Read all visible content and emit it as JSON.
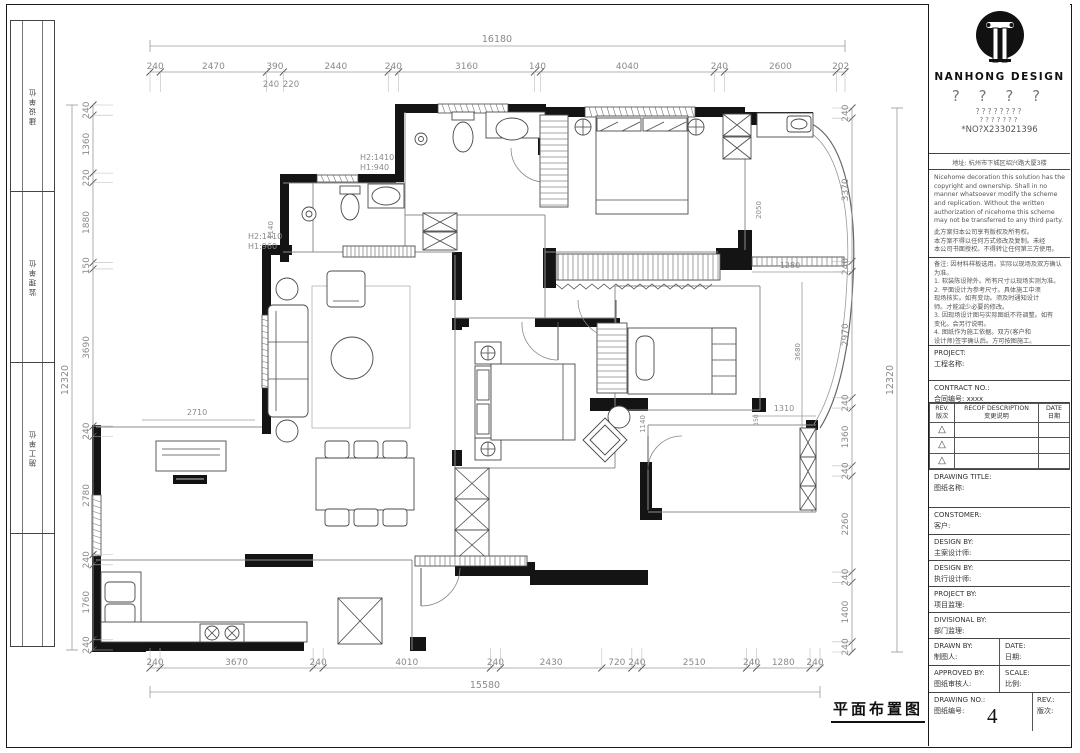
{
  "meta": {
    "drawing_title": "平面布置图",
    "page_number": "4"
  },
  "left_strip": {
    "cells": [
      "建设单位",
      "监理单位",
      "施工单位"
    ]
  },
  "title_block": {
    "brand": "NANHONG  DESIGN",
    "q1": "? ? ? ?",
    "q2": "????????",
    "q3": "???????",
    "serial": "*NO?X233021396",
    "address": "地址: 杭州市下城区绍兴路大厦3楼",
    "copyright_en": "Nicehome decoration this solution has the copyright and ownership. Shall in no manner whatsoever modify the scheme and replication. Without the written authorization of nicehome this scheme may not be transferred to any third party.",
    "copyright_cn": "此方案归本公司享有版权及所有权。\n本方案不得以任何方式修改及复制。未经\n本公司书面授权。不得转让任何第三方使用。",
    "notes": "备注: 因材料样板选用。实际以现场及双方确认为准。\n1. 软装陈设除外。所有尺寸以现场实测为准。\n2. 平面设计为参考尺寸。具体施工中须\n现场核实。如有变动。须及时通知设计\n师。才能减少必要的修改。\n3. 因现场设计图与实际图纸不符调整。如有\n变化。会另行说明。\n4. 图纸作为施工依据。双方(客户和\n设计师)签字确认后。方可按图施工。",
    "project_en": "PROJECT:",
    "project_cn": "工程名称:",
    "contract_en": "CONTRACT NO.:",
    "contract_cn": "合同编号: xxxx",
    "rev_en": "REV.",
    "rev_cn": "版次",
    "desc_en": "RECOF DESCRIPTION",
    "desc_cn": "变更说明",
    "date_en": "DATE",
    "date_cn": "日期",
    "tri": "△",
    "drawtitle_en": "DRAWING TITLE:",
    "drawtitle_cn": "图纸名称:",
    "customer_en": "CONSTOMER:",
    "customer_cn": "客户:",
    "design1_en": "DESIGN BY:",
    "design1_cn": "主案设计师:",
    "design2_en": "DESIGN BY:",
    "design2_cn": "执行设计师:",
    "projectby_en": "PROJECT BY:",
    "projectby_cn": "项目监理:",
    "divisional_en": "DIVISIONAL BY:",
    "divisional_cn": "部门监理:",
    "drawn_en": "DRAWN BY:",
    "drawn_cn": "制图人:",
    "date2_en": "DATE:",
    "date2_cn": "日期:",
    "approved_en": "APPROVED BY:",
    "approved_cn": "图纸审核人:",
    "scale_en": "SCALE:",
    "scale_cn": "比例:",
    "no_en": "DRAWING NO.:",
    "no_cn": "图纸编号:",
    "rev2_en": "REV.:",
    "rev2_cn": "版次:"
  },
  "dimensions": {
    "top": [
      "240",
      "2470",
      "390",
      "2440",
      "240",
      "3160",
      "140",
      "4040",
      "240",
      "2600",
      "202"
    ],
    "top_total": "16180",
    "top_sub": [
      "240",
      "220"
    ],
    "bottom": [
      "240",
      "3670",
      "240",
      "4010",
      "240",
      "2430",
      "720",
      "240",
      "2510",
      "240",
      "1280",
      "240"
    ],
    "bottom_total": "15580",
    "left": [
      "240",
      "1360",
      "220",
      "1880",
      "150",
      "3690",
      "240",
      "2780",
      "240",
      "1760",
      "240"
    ],
    "left_total": "12320",
    "right": [
      "240",
      "3370",
      "240",
      "2970",
      "240",
      "1360",
      "240",
      "2260",
      "240",
      "1400",
      "240"
    ],
    "right_total": "12320"
  },
  "plan_labels": {
    "h940a": "H2:1410",
    "h940b": "H1:940",
    "h960a": "H2:1410",
    "h960b": "H1:960",
    "d1140_bath": "1140",
    "d2710": "2710",
    "d1140_bed": "1140",
    "d2050": "2050",
    "d1280": "1280",
    "d3680": "3680",
    "d1310": "1310",
    "d150": "150"
  }
}
